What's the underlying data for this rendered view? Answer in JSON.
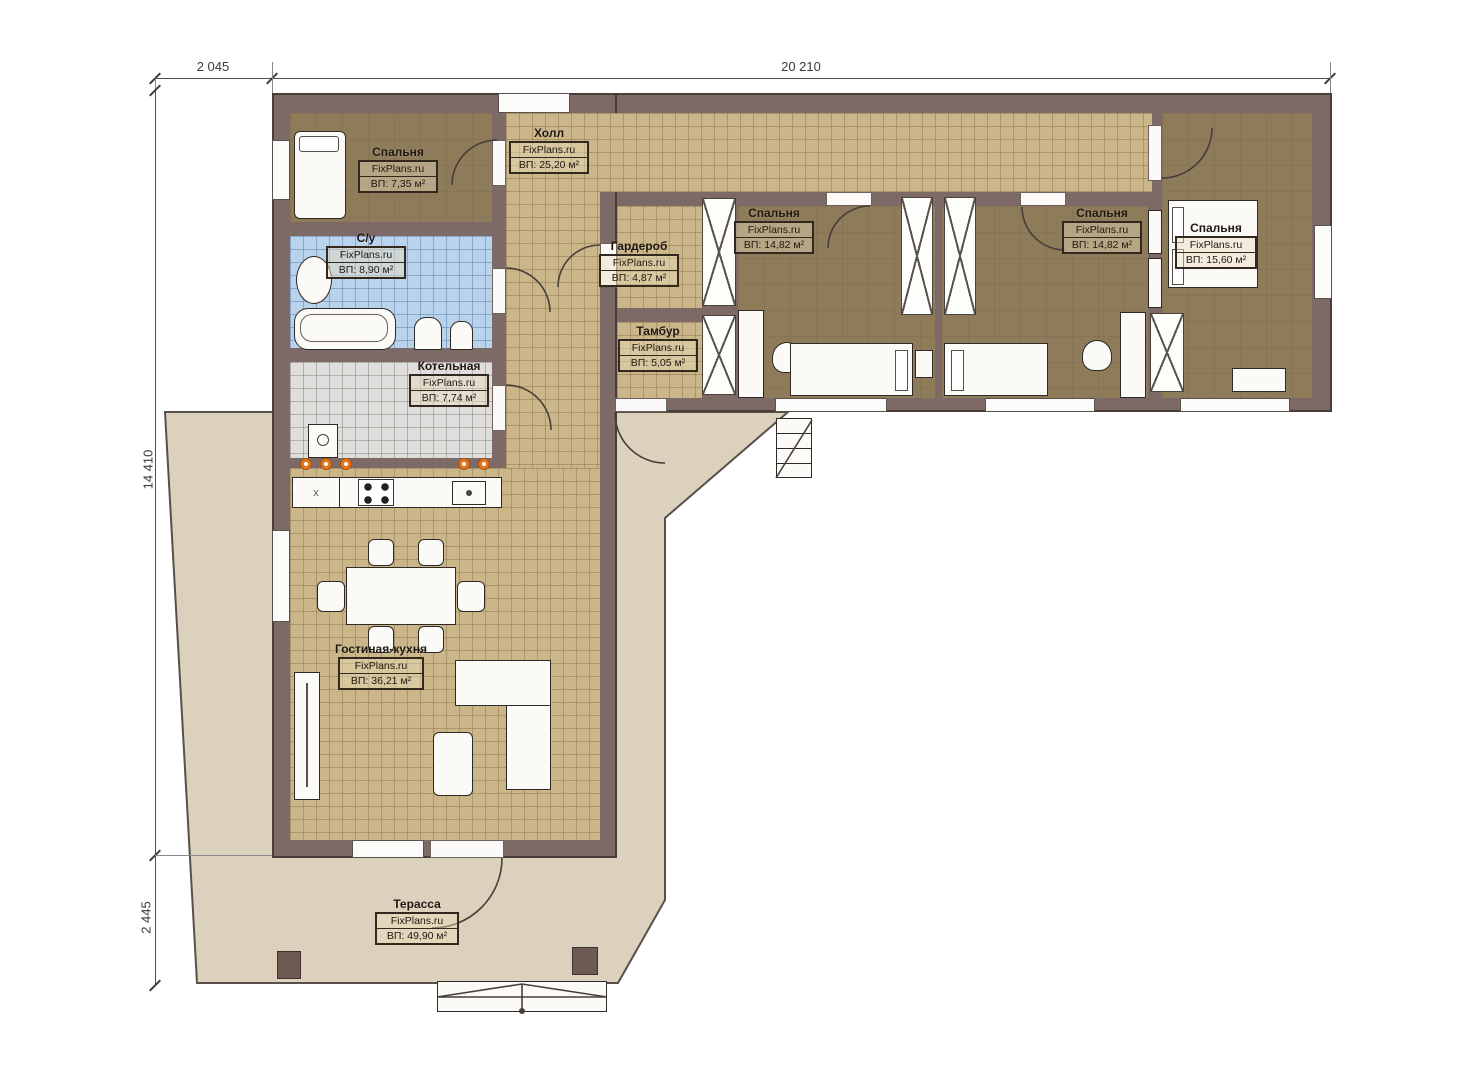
{
  "title": "План одноэтажного дома (FixPlans.ru)",
  "brand": "FixPlans.ru",
  "dimensions": {
    "top_left": "2 045",
    "top_right": "20 210",
    "left_upper": "14 410",
    "left_lower": "2 445"
  },
  "rooms": [
    {
      "id": "bedroom-top-left",
      "name": "Спальня",
      "brand": "FixPlans.ru",
      "area": "ВП: 7,35 м²"
    },
    {
      "id": "hall",
      "name": "Холл",
      "brand": "FixPlans.ru",
      "area": "ВП: 25,20 м²"
    },
    {
      "id": "bathroom",
      "name": "С/у",
      "brand": "FixPlans.ru",
      "area": "ВП: 8,90 м²"
    },
    {
      "id": "wardrobe",
      "name": "Гардероб",
      "brand": "FixPlans.ru",
      "area": "ВП: 4,87 м²"
    },
    {
      "id": "vestibule",
      "name": "Тамбур",
      "brand": "FixPlans.ru",
      "area": "ВП: 5,05 м²"
    },
    {
      "id": "boiler-room",
      "name": "Котельная",
      "brand": "FixPlans.ru",
      "area": "ВП: 7,74 м²"
    },
    {
      "id": "bedroom-middle",
      "name": "Спальня",
      "brand": "FixPlans.ru",
      "area": "ВП: 14,82 м²"
    },
    {
      "id": "bedroom-right",
      "name": "Спальня",
      "brand": "FixPlans.ru",
      "area": "ВП: 14,82 м²"
    },
    {
      "id": "bedroom-far-right",
      "name": "Спальня",
      "brand": "FixPlans.ru",
      "area": "ВП: 15,60 м²"
    },
    {
      "id": "living-kitchen",
      "name": "Гостиная-кухня",
      "brand": "FixPlans.ru",
      "area": "ВП: 36,21 м²"
    },
    {
      "id": "terrace",
      "name": "Терасса",
      "brand": "FixPlans.ru",
      "area": "ВП: 49,90 м²"
    }
  ],
  "kitchen": {
    "cabinet_mark": "x"
  },
  "colors": {
    "wall": "#7d6965",
    "wall_outline": "#473d39",
    "floor_bedroom": "#8e7b5a",
    "floor_tile_tan": "#cbb689",
    "floor_tile_blue": "#b9d3ed",
    "floor_tile_gray": "#e0dedc",
    "terrace": "#dcd1bc",
    "accent_orange": "#e4761f",
    "furniture": "#fbfaf7"
  }
}
